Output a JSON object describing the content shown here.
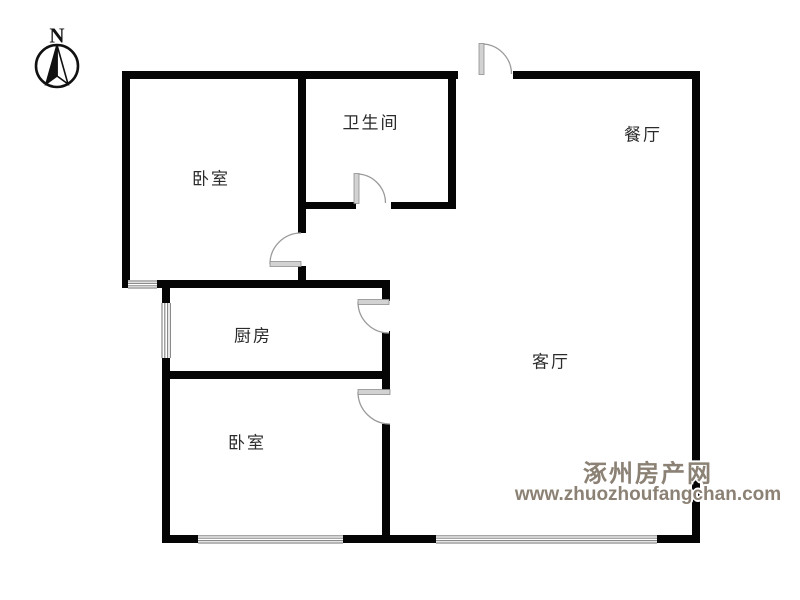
{
  "compass": {
    "label": "N"
  },
  "rooms": [
    {
      "id": "bedroom-top",
      "label": "卧室"
    },
    {
      "id": "bathroom",
      "label": "卫生间"
    },
    {
      "id": "dining-room",
      "label": "餐厅"
    },
    {
      "id": "kitchen",
      "label": "厨房"
    },
    {
      "id": "living-room",
      "label": "客厅"
    },
    {
      "id": "bedroom-bottom",
      "label": "卧室"
    }
  ],
  "watermark": {
    "site_name": "涿州房产网",
    "site_url": "www.zhuozhoufangchan.com",
    "color": "#8b8174"
  },
  "colors": {
    "wall": "#050505",
    "door_panel": "#d2d2d2",
    "door_arc": "#9a9a9a",
    "window_line": "#8a8a8a",
    "label_text": "#2b2b2b"
  },
  "icons": [
    {
      "name": "north-compass-icon",
      "meaning": "north direction indicator"
    }
  ]
}
